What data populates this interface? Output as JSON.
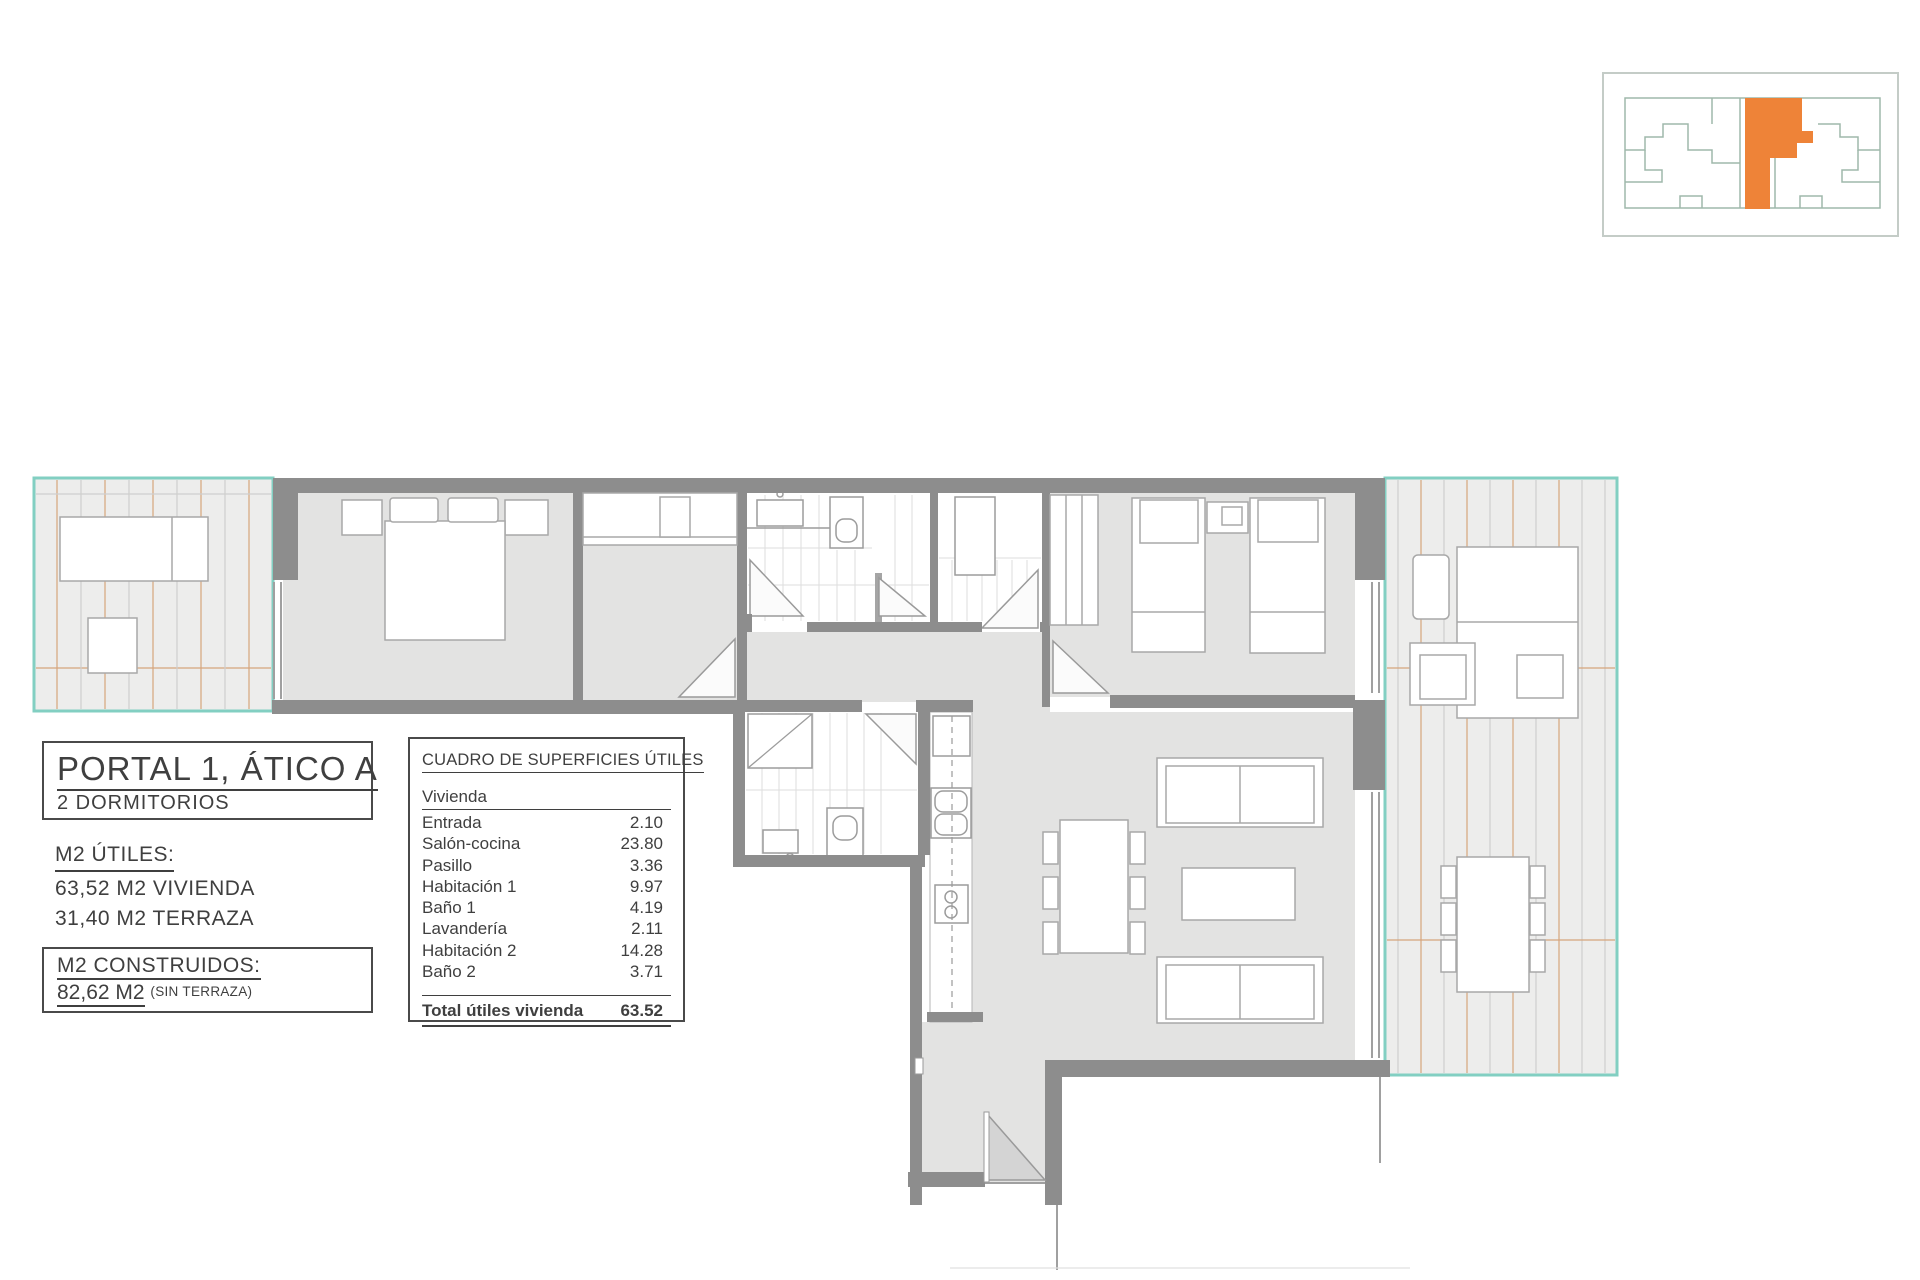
{
  "title_block": {
    "title": "PORTAL 1, ÁTICO A",
    "subtitle": "2 DORMITORIOS",
    "utiles_heading": "M2 ÚTILES:",
    "utiles_line1": "63,52 M2 VIVIENDA",
    "utiles_line2": "31,40 M2 TERRAZA",
    "construidos_heading": "M2 CONSTRUIDOS:",
    "construidos_value": "82,62 M2",
    "construidos_note": "(SIN TERRAZA)"
  },
  "surface_table": {
    "title": "CUADRO DE SUPERFICIES ÚTILES",
    "group": "Vivienda",
    "rows": [
      {
        "label": "Entrada",
        "value": "2.10"
      },
      {
        "label": "Salón-cocina",
        "value": "23.80"
      },
      {
        "label": "Pasillo",
        "value": "3.36"
      },
      {
        "label": "Habitación 1",
        "value": "9.97"
      },
      {
        "label": "Baño 1",
        "value": "4.19"
      },
      {
        "label": "Lavandería",
        "value": "2.11"
      },
      {
        "label": "Habitación 2",
        "value": "14.28"
      },
      {
        "label": "Baño 2",
        "value": "3.71"
      }
    ],
    "total_label": "Total útiles vivienda",
    "total_value": "63.52"
  },
  "colors": {
    "highlight_orange": "#ee8338",
    "terrace_teal": "#82cfc2",
    "wall_gray": "#8d8d8d",
    "floor_gray": "#e3e3e2",
    "deck_tan": "#d6a57c"
  }
}
